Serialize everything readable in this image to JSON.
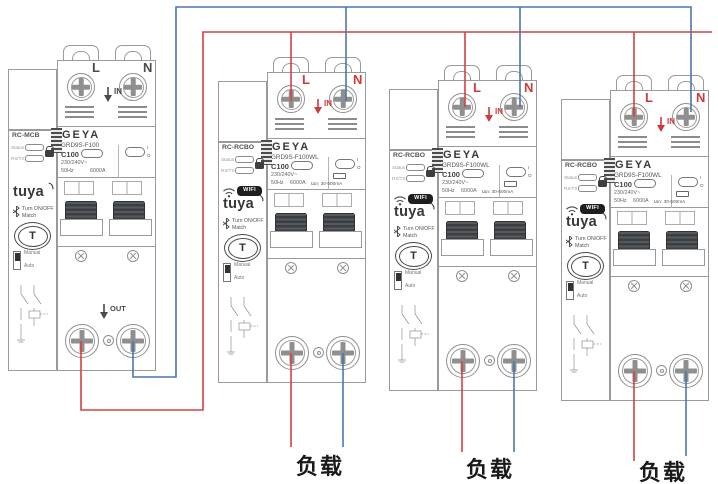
{
  "colors": {
    "live_wire": "#d24242",
    "neutral_wire": "#4878a8",
    "outline": "#9a9a9a",
    "terminal_label_red": "#cf3a3a"
  },
  "loads": {
    "label_1": "负载",
    "label_2": "负载",
    "label_3": "负载"
  },
  "devices": [
    {
      "type": "RC-MCB",
      "brand": "GEYA",
      "model": "GRD9S-F100",
      "status_label": "Status",
      "rxtx_label": "RX/TX",
      "current_rating": "C100",
      "voltage": "230/240V~",
      "frequency": "50Hz",
      "breaking_capacity": "6000A",
      "on_mark": "I",
      "off_mark": "O",
      "tuya_logo": "tuya",
      "match_line1": "Turn ON/OFF",
      "match_line2": "Match",
      "t_button": "T",
      "manual_label": "Manual",
      "auto_label": "Auto",
      "terminal_live": "L",
      "terminal_neutral": "N",
      "in_label": "IN",
      "out_label": "OUT"
    },
    {
      "type": "RC-RCBO",
      "brand": "GEYA",
      "model": "GRD9S-F100WL",
      "status_label": "Status",
      "rxtx_label": "RX/TX",
      "wifi_badge": "WIFI",
      "current_rating": "C100",
      "voltage": "230/240V~",
      "frequency": "50Hz",
      "breaking_capacity": "6000A",
      "leakage_rating": "IΔn: 30-500mA",
      "on_mark": "I",
      "off_mark": "O",
      "tuya_logo": "tuya",
      "match_line1": "Turn ON/OFF",
      "match_line2": "Match",
      "t_button": "T",
      "manual_label": "Manual",
      "auto_label": "Auto",
      "terminal_live": "L",
      "terminal_neutral": "N",
      "in_label": "IN"
    },
    {
      "type": "RC-RCBO",
      "brand": "GEYA",
      "model": "GRD9S-F100WL",
      "status_label": "Status",
      "rxtx_label": "RX/TX",
      "wifi_badge": "WIFI",
      "current_rating": "C100",
      "voltage": "230/240V~",
      "frequency": "50Hz",
      "breaking_capacity": "6000A",
      "leakage_rating": "IΔn: 30-500mA",
      "on_mark": "I",
      "off_mark": "O",
      "tuya_logo": "tuya",
      "match_line1": "Turn ON/OFF",
      "match_line2": "Match",
      "t_button": "T",
      "manual_label": "Manual",
      "auto_label": "Auto",
      "terminal_live": "L",
      "terminal_neutral": "N",
      "in_label": "IN"
    },
    {
      "type": "RC-RCBO",
      "brand": "GEYA",
      "model": "GRD9S-F100WL",
      "status_label": "Status",
      "rxtx_label": "RX/TX",
      "wifi_badge": "WIFI",
      "current_rating": "C100",
      "voltage": "230/240V~",
      "frequency": "50Hz",
      "breaking_capacity": "6000A",
      "leakage_rating": "IΔn: 30-500mA",
      "on_mark": "I",
      "off_mark": "O",
      "tuya_logo": "tuya",
      "match_line1": "Turn ON/OFF",
      "match_line2": "Match",
      "t_button": "T",
      "manual_label": "Manual",
      "auto_label": "Auto",
      "terminal_live": "L",
      "terminal_neutral": "N",
      "in_label": "IN"
    }
  ]
}
